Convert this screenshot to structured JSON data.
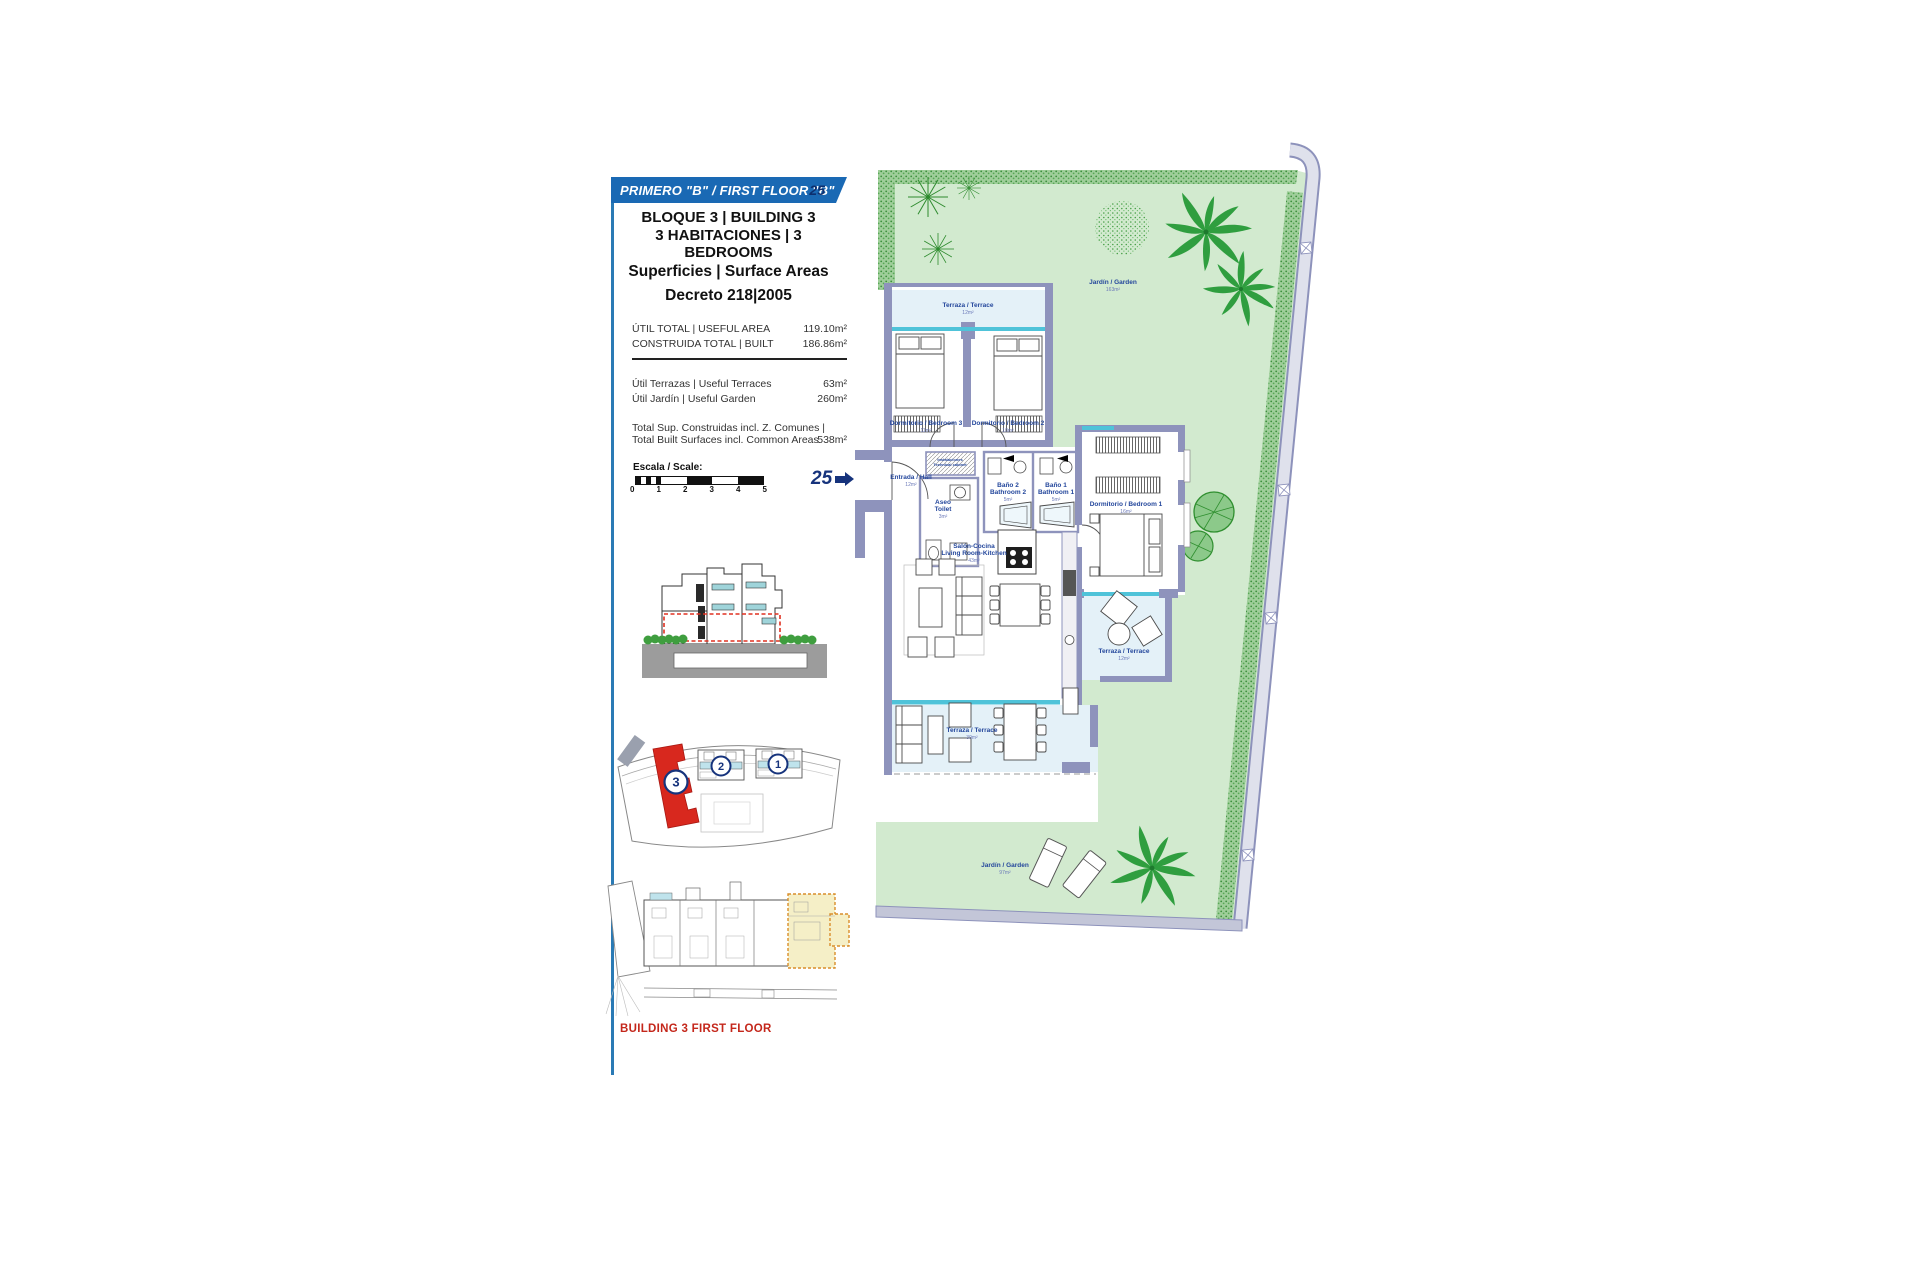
{
  "colors": {
    "banner_blue": "#1a69b4",
    "navy": "#16337c",
    "label_blue": "#24479c",
    "red": "#d42a1e",
    "wall_lavender": "#8e93bc",
    "glazing_cyan": "#4fc3d9",
    "terrace_blue": "#e4f1f8",
    "garden_green": "#d2eacf",
    "highlight_yellow": "#f5efc7"
  },
  "panel": {
    "banner": {
      "title": "PRIMERO  \"B\" / FIRST FLOOR \"B\"",
      "number": "25"
    },
    "building_line": "BLOQUE 3 | BUILDING 3",
    "bedrooms_line": "3 HABITACIONES | 3 BEDROOMS",
    "surface_title": "Superficies | Surface Areas",
    "decree": "Decreto 218|2005",
    "rows_primary": [
      {
        "label": "ÚTIL TOTAL | USEFUL  AREA",
        "value": "119.10m²"
      },
      {
        "label": "CONSTRUIDA TOTAL | BUILT",
        "value": "186.86m²"
      }
    ],
    "rows_secondary": [
      {
        "label": "Útil Terrazas | Useful Terraces",
        "value": "63m²"
      },
      {
        "label": "Útil Jardín | Useful Garden",
        "value": "260m²"
      }
    ],
    "total_row": {
      "label1": "Total Sup. Construidas incl. Z. Comunes |",
      "label2": "Total Built Surfaces incl. Common Areas",
      "value": "538m²"
    },
    "scale": {
      "label": "Escala / Scale:",
      "ticks": [
        "0",
        "1",
        "2",
        "3",
        "4",
        "5"
      ]
    },
    "caption": "BUILDING 3 FIRST FLOOR"
  },
  "siteplan": {
    "building1": "1",
    "building2": "2",
    "building3": "3"
  },
  "plan": {
    "entry": {
      "number": "25"
    },
    "rooms": {
      "terrace_top": {
        "name": "Terraza / Terrace",
        "area": "12m²"
      },
      "bedroom3": {
        "name": "Dormitorio / Bedroom 3",
        "area": "11m²"
      },
      "bedroom2": {
        "name": "Dormitorio / Bedroom 2",
        "area": "10m²"
      },
      "hall": {
        "name": "Entrada / Hall",
        "area": "12m²"
      },
      "tech": {
        "name1": "Instalaciones",
        "name2": "Technical cabinet"
      },
      "toilet": {
        "name1": "Aseo",
        "name2": "Toilet",
        "area": "3m²"
      },
      "bath2": {
        "name1": "Baño 2",
        "name2": "Bathroom 2",
        "area": "5m²"
      },
      "bath1": {
        "name1": "Baño 1",
        "name2": "Bathroom 1",
        "area": "5m²"
      },
      "bedroom1": {
        "name": "Dormitorio / Bedroom 1",
        "area": "16m²"
      },
      "living": {
        "name1": "Salón-Cocina",
        "name2": "Living Room-Kitchen",
        "area": "43m²"
      },
      "terrace_side": {
        "name": "Terraza / Terrace",
        "area": "12m²"
      },
      "terrace_main": {
        "name": "Terraza / Terrace",
        "area": "39m²"
      },
      "garden_top": {
        "name": "Jardín / Garden",
        "area": "163m²"
      },
      "garden_bottom": {
        "name": "Jardín / Garden",
        "area": "97m²"
      }
    }
  }
}
